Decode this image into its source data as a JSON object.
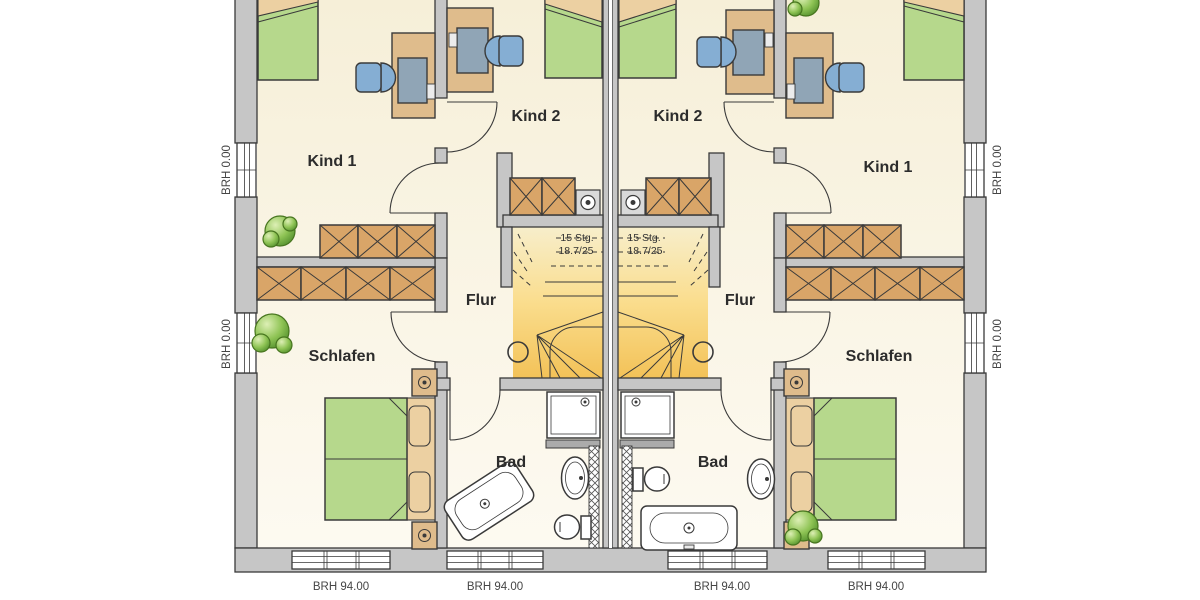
{
  "labels": {
    "left_unit": {
      "kind1": "Kind 1",
      "kind2": "Kind 2",
      "flur": "Flur",
      "schlafen": "Schlafen",
      "bad": "Bad",
      "stairs_line1": "15 Stg.",
      "stairs_line2": "18.7/25"
    },
    "right_unit": {
      "kind1": "Kind 1",
      "kind2": "Kind 2",
      "flur": "Flur",
      "schlafen": "Schlafen",
      "bad": "Bad",
      "stairs_line1": "15 Stg.",
      "stairs_line2": "18.7/25"
    },
    "window_sills": {
      "left_wall_upper": "BRH 0.00",
      "left_wall_lower": "BRH 0.00",
      "right_wall_upper": "BRH 0.00",
      "right_wall_lower": "BRH 0.00",
      "bottom_window_1": "BRH 94.00",
      "bottom_window_2": "BRH 94.00",
      "bottom_window_3": "BRH 94.00",
      "bottom_window_4": "BRH 94.00"
    }
  },
  "colors": {
    "wall": "#c6c6c6",
    "outline": "#3a3a3a",
    "floor_top": "#f6efd8",
    "floor_bottom": "#fdfaf1",
    "stair_yellow": "#f3c258",
    "wood": "#d9a568",
    "furniture_wood": "#dfbc8c",
    "bed_green": "#b6d88c",
    "pillow_tan": "#ecd0a2",
    "chair_blue": "#85aed3",
    "monitor_gray": "#90a5b6",
    "plant_green": "#79b544",
    "label_dark": "#2c2c2c",
    "label_gray": "#454545"
  }
}
